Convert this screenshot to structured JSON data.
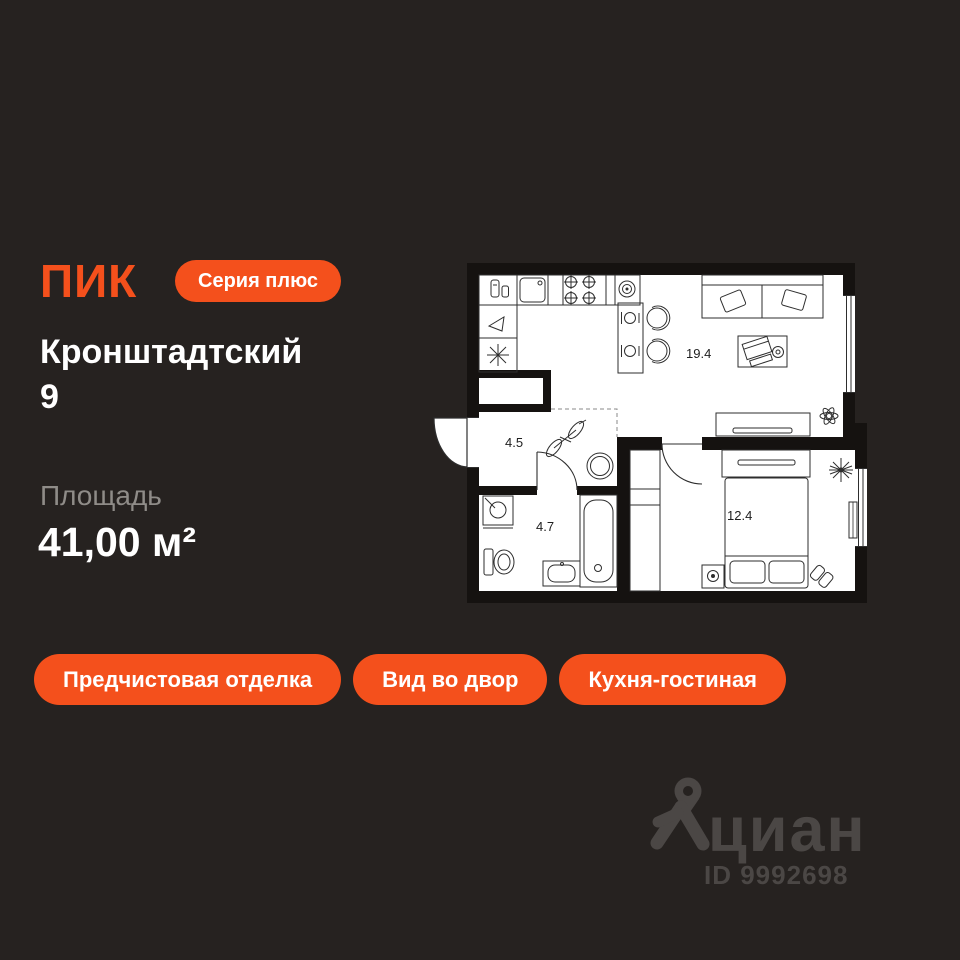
{
  "brand": {
    "logo_text": "ПИК",
    "series_badge": "Серия плюс"
  },
  "listing": {
    "project_name": "Кронштадтский",
    "building_number": "9",
    "area_label": "Площадь",
    "area_value": "41,00 м²"
  },
  "floorplan": {
    "room_labels": {
      "kitchen_living": "19.4",
      "hallway": "4.5",
      "bathroom": "4.7",
      "bedroom": "12.4"
    }
  },
  "features": [
    "Предчистовая отделка",
    "Вид во двор",
    "Кухня-гостиная"
  ],
  "watermark": {
    "brand_text": "циан",
    "listing_id": "ID 9992698"
  },
  "colors": {
    "background": "#262220",
    "accent": "#F4501C",
    "text_primary": "#FFFFFF",
    "text_muted": "#8F8C88",
    "watermark": "#4B4745",
    "plan_walls": "#151210",
    "plan_lines": "#2E2E2E"
  }
}
